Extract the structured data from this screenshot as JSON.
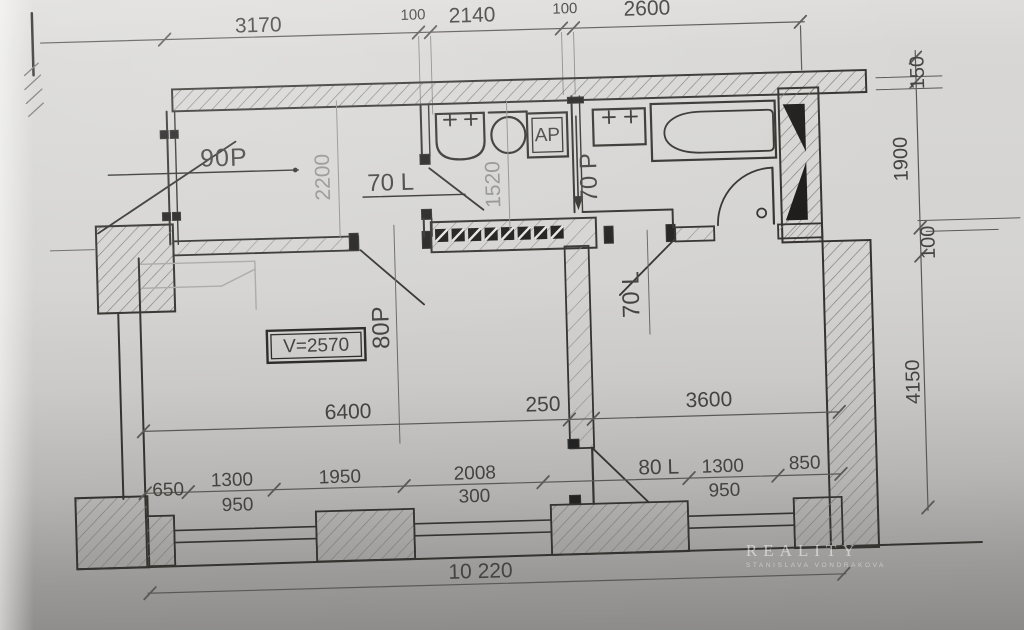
{
  "watermark": {
    "brand": "REALITY",
    "subtitle": "STANISLAVA VONDRAKOVA"
  },
  "plan": {
    "ceiling_height_label": "V=2570",
    "appliance_label": "AP",
    "total_width": "10 220",
    "dims_top": [
      "3170",
      "100",
      "2140",
      "100",
      "2600"
    ],
    "dims_right": [
      "150",
      "1900",
      "100",
      "4150"
    ],
    "dims_middle": [
      "6400",
      "250",
      "3600"
    ],
    "dims_bottom_upper": [
      "650",
      "1300",
      "1950",
      "2008",
      "80 L",
      "1300",
      "850"
    ],
    "dims_bottom_lower": [
      "950",
      "300",
      "950"
    ],
    "dims_interior": [
      "2200",
      "1520"
    ],
    "door_labels": {
      "entry": "90P",
      "hall_wc": "70 L",
      "bathroom_slide": "70 P",
      "living": "80P",
      "room2": "70 L"
    }
  }
}
